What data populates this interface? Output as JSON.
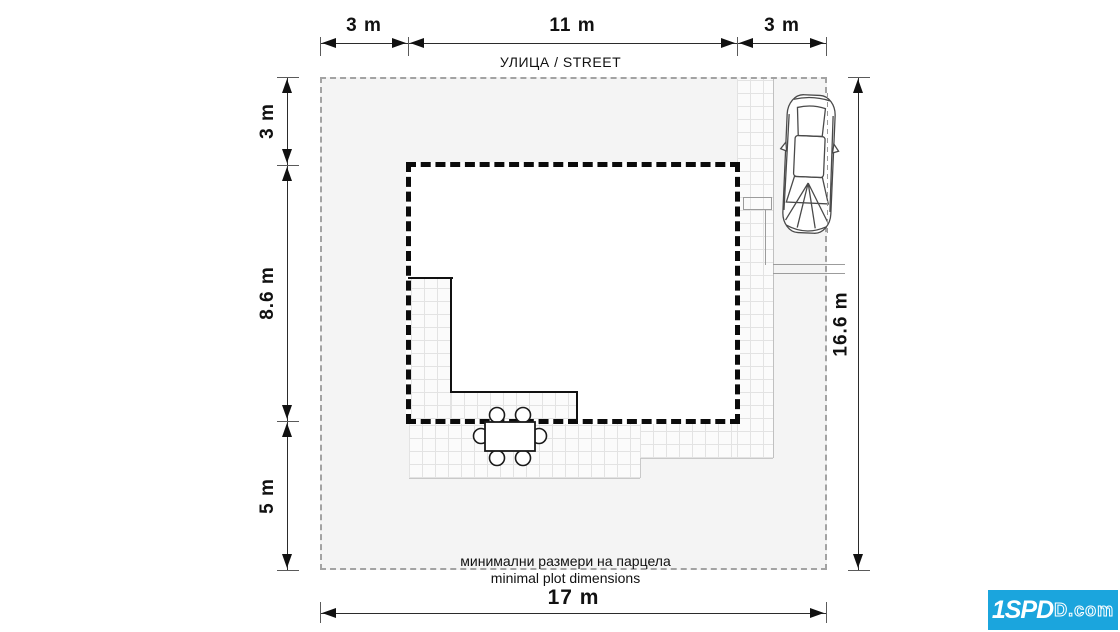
{
  "title": "site plan — minimal plot dimensions",
  "street": {
    "label": "УЛИЦА / STREET"
  },
  "dimensions": {
    "top": [
      {
        "label": "3 m"
      },
      {
        "label": "11 m"
      },
      {
        "label": "3 m"
      }
    ],
    "left": [
      {
        "label": "3 m"
      },
      {
        "label": "8.6 m"
      },
      {
        "label": "5 m"
      }
    ],
    "right": {
      "label": "16.6 m"
    },
    "bottom": {
      "label": "17 m"
    }
  },
  "caption": {
    "line1": "минимални размери на парцела",
    "line2": "minimal plot dimensions"
  },
  "logo": {
    "brand": "1SPD",
    "suffix": "D.com",
    "bg_color": "#1ba5dd"
  },
  "icons": {
    "car": "car-top-view-icon",
    "table": "dining-table-icon"
  },
  "colors": {
    "plot_fill": "#f4f4f4",
    "hatch_line": "#e3e3e3",
    "house_outline": "#0b0b0b",
    "plot_dash": "#a3a3a3",
    "dim_line": "#2b2b2b"
  }
}
